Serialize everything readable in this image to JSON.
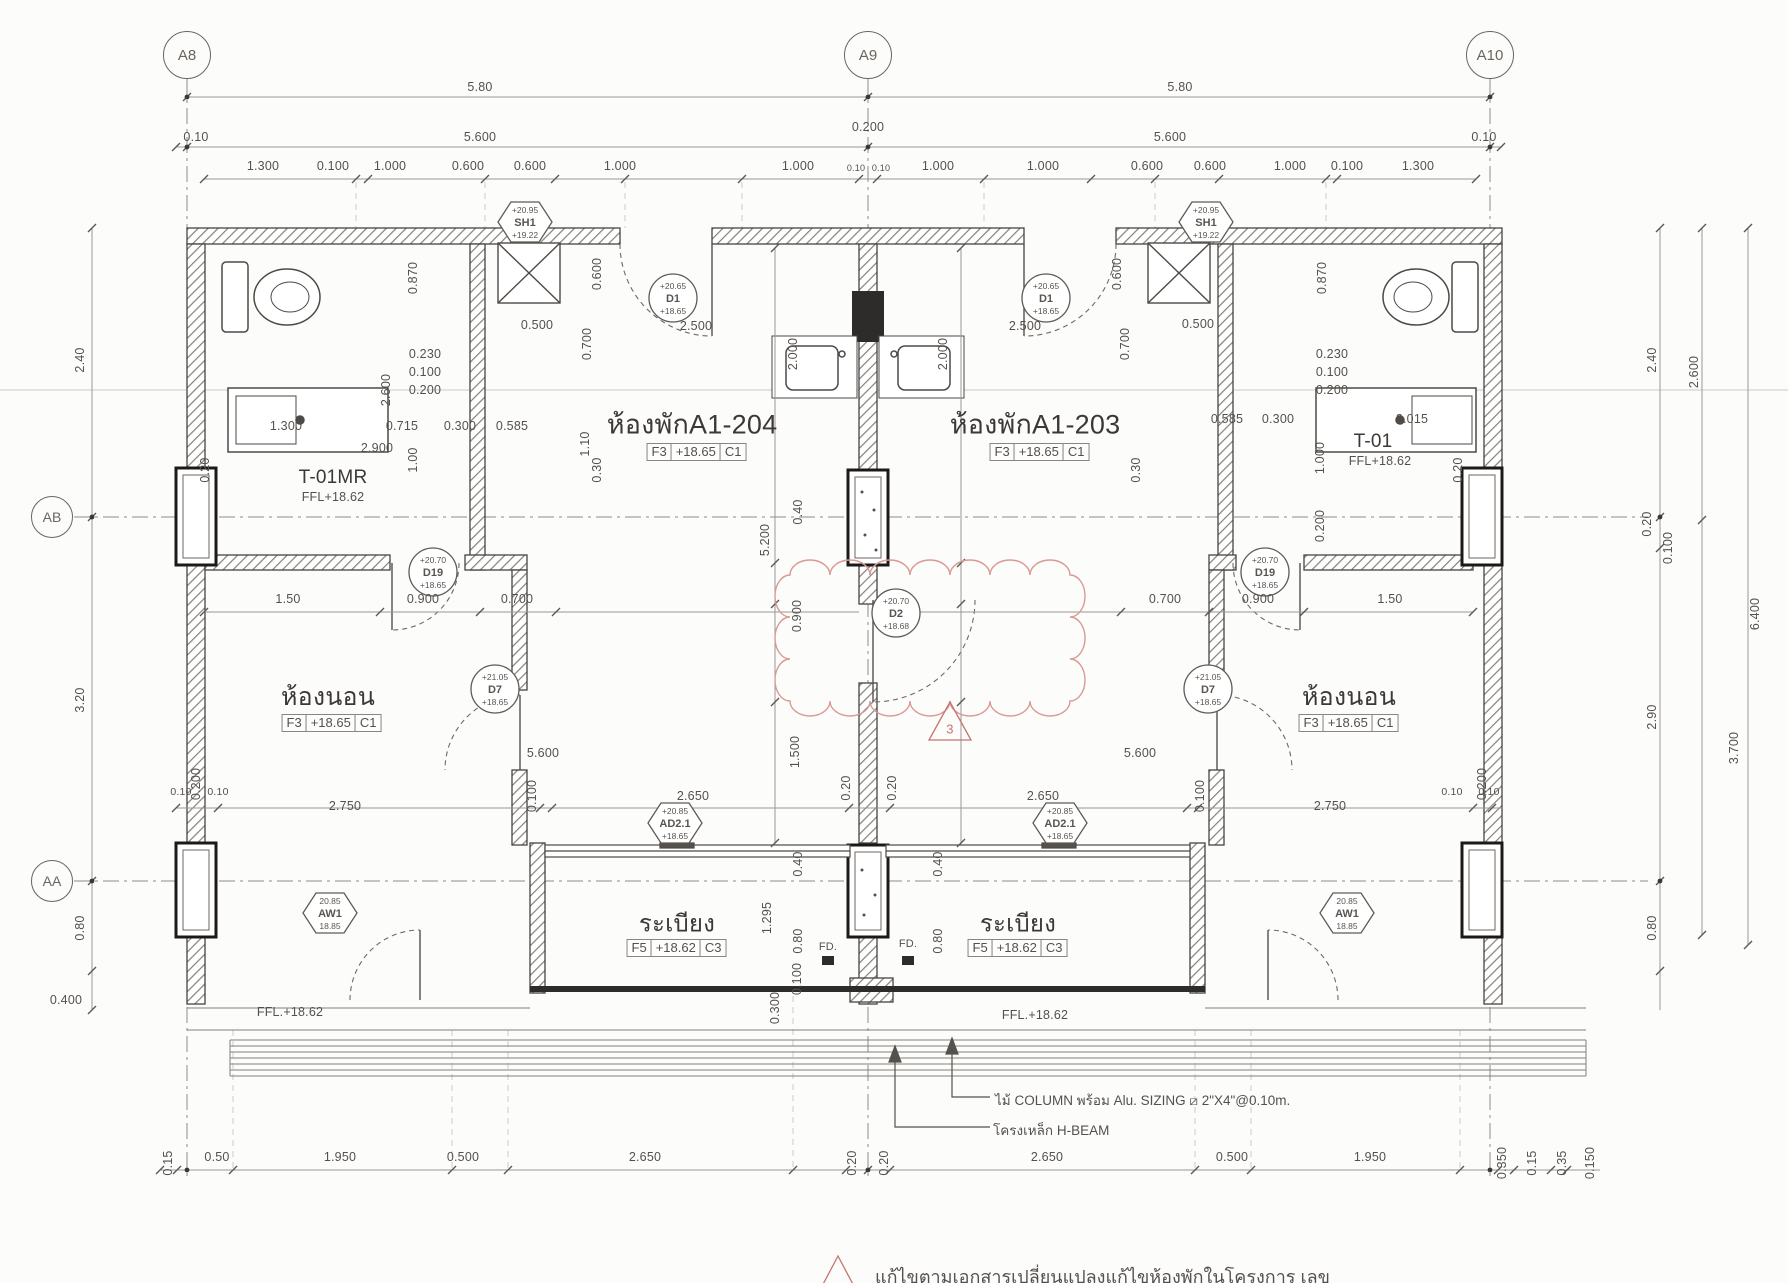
{
  "plan": {
    "grid_bubbles": [
      {
        "id": "A8",
        "x": 187,
        "y": 55,
        "d": 46
      },
      {
        "id": "A9",
        "x": 868,
        "y": 55,
        "d": 46
      },
      {
        "id": "A10",
        "x": 1490,
        "y": 55,
        "d": 46
      },
      {
        "id": "AB",
        "x": 52,
        "y": 517,
        "d": 40
      },
      {
        "id": "AA",
        "x": 52,
        "y": 881,
        "d": 40
      }
    ],
    "rooms": [
      {
        "name": "ห้องพักA1-204",
        "x": 692,
        "y": 424,
        "size": 27,
        "box": [
          "F3",
          "+18.65",
          "C1"
        ],
        "bx": 697,
        "by": 452
      },
      {
        "name": "ห้องพักA1-203",
        "x": 1035,
        "y": 424,
        "size": 27,
        "box": [
          "F3",
          "+18.65",
          "C1"
        ],
        "bx": 1040,
        "by": 452
      },
      {
        "name": "ห้องนอน",
        "x": 328,
        "y": 697,
        "size": 25,
        "box": [
          "F3",
          "+18.65",
          "C1"
        ],
        "bx": 332,
        "by": 723
      },
      {
        "name": "ห้องนอน",
        "x": 1349,
        "y": 697,
        "size": 25,
        "box": [
          "F3",
          "+18.65",
          "C1"
        ],
        "bx": 1349,
        "by": 723
      },
      {
        "name": "ระเบียง",
        "x": 677,
        "y": 923,
        "size": 24,
        "box": [
          "F5",
          "+18.62",
          "C3"
        ],
        "bx": 677,
        "by": 948
      },
      {
        "name": "ระเบียง",
        "x": 1018,
        "y": 923,
        "size": 24,
        "box": [
          "F5",
          "+18.62",
          "C3"
        ],
        "bx": 1018,
        "by": 948
      },
      {
        "name": "T-01MR",
        "x": 333,
        "y": 478,
        "size": 19,
        "sub": "FFL+18.62",
        "sx": 333,
        "sy": 497
      },
      {
        "name": "T-01",
        "x": 1373,
        "y": 442,
        "size": 19,
        "sub": "FFL+18.62",
        "sx": 1380,
        "sy": 461
      }
    ],
    "tags": [
      {
        "code": "D1",
        "shape": "circle",
        "x": 673,
        "y": 298,
        "top": "+20.65",
        "bottom": "+18.65"
      },
      {
        "code": "D1",
        "shape": "circle",
        "x": 1046,
        "y": 298,
        "top": "+20.65",
        "bottom": "+18.65"
      },
      {
        "code": "D19",
        "shape": "circle",
        "x": 433,
        "y": 572,
        "top": "+20.70",
        "bottom": "+18.65"
      },
      {
        "code": "D19",
        "shape": "circle",
        "x": 1265,
        "y": 572,
        "top": "+20.70",
        "bottom": "+18.65"
      },
      {
        "code": "D2",
        "shape": "circle",
        "x": 896,
        "y": 613,
        "top": "+20.70",
        "bottom": "+18.68"
      },
      {
        "code": "D7",
        "shape": "circle",
        "x": 495,
        "y": 689,
        "top": "+21.05",
        "bottom": "+18.65"
      },
      {
        "code": "D7",
        "shape": "circle",
        "x": 1208,
        "y": 689,
        "top": "+21.05",
        "bottom": "+18.65"
      },
      {
        "code": "SH1",
        "shape": "hex",
        "x": 525,
        "y": 222,
        "top": "+20.95",
        "bottom": "+19.22"
      },
      {
        "code": "SH1",
        "shape": "hex",
        "x": 1206,
        "y": 222,
        "top": "+20.95",
        "bottom": "+19.22"
      },
      {
        "code": "AD2.1",
        "shape": "hex",
        "x": 675,
        "y": 823,
        "top": "+20.85",
        "bottom": "+18.65"
      },
      {
        "code": "AD2.1",
        "shape": "hex",
        "x": 1060,
        "y": 823,
        "top": "+20.85",
        "bottom": "+18.65"
      },
      {
        "code": "AW1",
        "shape": "hex",
        "x": 330,
        "y": 913,
        "top": "20.85",
        "bottom": "18.85"
      },
      {
        "code": "AW1",
        "shape": "hex",
        "x": 1347,
        "y": 913,
        "top": "20.85",
        "bottom": "18.85"
      }
    ],
    "dims": [
      {
        "t": "5.80",
        "x": 480,
        "y": 87
      },
      {
        "t": "5.80",
        "x": 1180,
        "y": 87
      },
      {
        "t": "0.10",
        "x": 196,
        "y": 137
      },
      {
        "t": "5.600",
        "x": 480,
        "y": 137
      },
      {
        "t": "0.200",
        "x": 868,
        "y": 127
      },
      {
        "t": "5.600",
        "x": 1170,
        "y": 137
      },
      {
        "t": "0.10",
        "x": 1484,
        "y": 137
      },
      {
        "t": "1.300",
        "x": 263,
        "y": 166
      },
      {
        "t": "0.100",
        "x": 333,
        "y": 166
      },
      {
        "t": "1.000",
        "x": 390,
        "y": 166
      },
      {
        "t": "0.600",
        "x": 468,
        "y": 166
      },
      {
        "t": "0.600",
        "x": 530,
        "y": 166
      },
      {
        "t": "1.000",
        "x": 620,
        "y": 166
      },
      {
        "t": "1.000",
        "x": 798,
        "y": 166
      },
      {
        "t": "0.10",
        "x": 856,
        "y": 168,
        "s": 9
      },
      {
        "t": "0.10",
        "x": 881,
        "y": 168,
        "s": 9
      },
      {
        "t": "1.000",
        "x": 938,
        "y": 166
      },
      {
        "t": "1.000",
        "x": 1043,
        "y": 166
      },
      {
        "t": "0.600",
        "x": 1147,
        "y": 166
      },
      {
        "t": "0.600",
        "x": 1210,
        "y": 166
      },
      {
        "t": "1.000",
        "x": 1290,
        "y": 166
      },
      {
        "t": "0.100",
        "x": 1347,
        "y": 166
      },
      {
        "t": "1.300",
        "x": 1418,
        "y": 166
      },
      {
        "t": "2.40",
        "x": 80,
        "y": 360,
        "r": 1
      },
      {
        "t": "3.20",
        "x": 80,
        "y": 700,
        "r": 1
      },
      {
        "t": "0.80",
        "x": 80,
        "y": 928,
        "r": 1
      },
      {
        "t": "0.400",
        "x": 66,
        "y": 1000
      },
      {
        "t": "2.40",
        "x": 1652,
        "y": 360,
        "r": 1
      },
      {
        "t": "0.20",
        "x": 1647,
        "y": 524,
        "r": 1
      },
      {
        "t": "0.100",
        "x": 1668,
        "y": 548,
        "r": 1
      },
      {
        "t": "2.90",
        "x": 1652,
        "y": 717,
        "r": 1
      },
      {
        "t": "0.80",
        "x": 1652,
        "y": 928,
        "r": 1
      },
      {
        "t": "2.600",
        "x": 1694,
        "y": 372,
        "r": 1
      },
      {
        "t": "3.700",
        "x": 1734,
        "y": 748,
        "r": 1
      },
      {
        "t": "6.400",
        "x": 1755,
        "y": 614,
        "r": 1
      },
      {
        "t": "0.15",
        "x": 168,
        "y": 1163,
        "r": 1
      },
      {
        "t": "0.50",
        "x": 217,
        "y": 1157
      },
      {
        "t": "1.950",
        "x": 340,
        "y": 1157
      },
      {
        "t": "0.500",
        "x": 463,
        "y": 1157
      },
      {
        "t": "2.650",
        "x": 645,
        "y": 1157
      },
      {
        "t": "0.20",
        "x": 852,
        "y": 1163,
        "r": 1
      },
      {
        "t": "0.20",
        "x": 884,
        "y": 1163,
        "r": 1
      },
      {
        "t": "2.650",
        "x": 1047,
        "y": 1157
      },
      {
        "t": "0.500",
        "x": 1232,
        "y": 1157
      },
      {
        "t": "1.950",
        "x": 1370,
        "y": 1157
      },
      {
        "t": "0.350",
        "x": 1502,
        "y": 1163,
        "r": 1
      },
      {
        "t": "0.15",
        "x": 1532,
        "y": 1163,
        "r": 1
      },
      {
        "t": "0.35",
        "x": 1562,
        "y": 1163,
        "r": 1
      },
      {
        "t": "0.150",
        "x": 1590,
        "y": 1163,
        "r": 1
      },
      {
        "t": "0.870",
        "x": 413,
        "y": 278,
        "r": 1
      },
      {
        "t": "0.500",
        "x": 537,
        "y": 325
      },
      {
        "t": "2.500",
        "x": 696,
        "y": 326
      },
      {
        "t": "0.600",
        "x": 597,
        "y": 274,
        "r": 1
      },
      {
        "t": "0.700",
        "x": 587,
        "y": 344,
        "r": 1
      },
      {
        "t": "0.230",
        "x": 425,
        "y": 354
      },
      {
        "t": "0.100",
        "x": 425,
        "y": 372
      },
      {
        "t": "0.200",
        "x": 425,
        "y": 390
      },
      {
        "t": "2.600",
        "x": 386,
        "y": 390,
        "r": 1
      },
      {
        "t": "1.300",
        "x": 286,
        "y": 426
      },
      {
        "t": "0.715",
        "x": 402,
        "y": 426
      },
      {
        "t": "0.300",
        "x": 460,
        "y": 426
      },
      {
        "t": "0.585",
        "x": 512,
        "y": 426
      },
      {
        "t": "2.900",
        "x": 377,
        "y": 448
      },
      {
        "t": "1.00",
        "x": 413,
        "y": 460,
        "r": 1
      },
      {
        "t": "2.000",
        "x": 793,
        "y": 354,
        "r": 1
      },
      {
        "t": "1.10",
        "x": 585,
        "y": 444,
        "r": 1
      },
      {
        "t": "0.20",
        "x": 205,
        "y": 470,
        "r": 1
      },
      {
        "t": "0.30",
        "x": 597,
        "y": 470,
        "r": 1
      },
      {
        "t": "5.200",
        "x": 765,
        "y": 540,
        "r": 1
      },
      {
        "t": "0.40",
        "x": 798,
        "y": 512,
        "r": 1
      },
      {
        "t": "0.900",
        "x": 797,
        "y": 616,
        "r": 1
      },
      {
        "t": "1.500",
        "x": 795,
        "y": 752,
        "r": 1
      },
      {
        "t": "1.50",
        "x": 288,
        "y": 599
      },
      {
        "t": "0.900",
        "x": 423,
        "y": 599
      },
      {
        "t": "0.700",
        "x": 517,
        "y": 599
      },
      {
        "t": "5.600",
        "x": 543,
        "y": 753
      },
      {
        "t": "0.200",
        "x": 196,
        "y": 784,
        "r": 1
      },
      {
        "t": "0.10",
        "x": 181,
        "y": 792,
        "s": 10.5
      },
      {
        "t": "0.10",
        "x": 218,
        "y": 792,
        "s": 10.5
      },
      {
        "t": "2.750",
        "x": 345,
        "y": 806
      },
      {
        "t": "0.100",
        "x": 532,
        "y": 796,
        "r": 1
      },
      {
        "t": "2.650",
        "x": 693,
        "y": 796
      },
      {
        "t": "0.20",
        "x": 846,
        "y": 788,
        "r": 1
      },
      {
        "t": "0.20",
        "x": 892,
        "y": 788,
        "r": 1
      },
      {
        "t": "0.40",
        "x": 798,
        "y": 864,
        "r": 1
      },
      {
        "t": "1.295",
        "x": 767,
        "y": 918,
        "r": 1
      },
      {
        "t": "0.80",
        "x": 798,
        "y": 941,
        "r": 1
      },
      {
        "t": "0.100",
        "x": 797,
        "y": 979,
        "r": 1
      },
      {
        "t": "0.300",
        "x": 775,
        "y": 1008,
        "r": 1
      },
      {
        "t": "0.870",
        "x": 1322,
        "y": 278,
        "r": 1
      },
      {
        "t": "0.500",
        "x": 1198,
        "y": 324
      },
      {
        "t": "2.500",
        "x": 1025,
        "y": 326
      },
      {
        "t": "0.600",
        "x": 1117,
        "y": 274,
        "r": 1
      },
      {
        "t": "0.700",
        "x": 1125,
        "y": 344,
        "r": 1
      },
      {
        "t": "0.230",
        "x": 1332,
        "y": 354
      },
      {
        "t": "0.100",
        "x": 1332,
        "y": 372
      },
      {
        "t": "0.200",
        "x": 1332,
        "y": 390
      },
      {
        "t": "0.585",
        "x": 1227,
        "y": 419
      },
      {
        "t": "0.300",
        "x": 1278,
        "y": 419
      },
      {
        "t": "2.015",
        "x": 1412,
        "y": 419
      },
      {
        "t": "1.000",
        "x": 1320,
        "y": 458,
        "r": 1
      },
      {
        "t": "0.200",
        "x": 1320,
        "y": 526,
        "r": 1
      },
      {
        "t": "2.000",
        "x": 943,
        "y": 354,
        "r": 1
      },
      {
        "t": "0.30",
        "x": 1136,
        "y": 470,
        "r": 1
      },
      {
        "t": "0.20",
        "x": 1458,
        "y": 470,
        "r": 1
      },
      {
        "t": "0.700",
        "x": 1165,
        "y": 599
      },
      {
        "t": "0.900",
        "x": 1258,
        "y": 599
      },
      {
        "t": "1.50",
        "x": 1390,
        "y": 599
      },
      {
        "t": "5.600",
        "x": 1140,
        "y": 753
      },
      {
        "t": "2.650",
        "x": 1043,
        "y": 796
      },
      {
        "t": "0.100",
        "x": 1200,
        "y": 796,
        "r": 1
      },
      {
        "t": "2.750",
        "x": 1330,
        "y": 806
      },
      {
        "t": "0.10",
        "x": 1452,
        "y": 792,
        "s": 10.5
      },
      {
        "t": "0.10",
        "x": 1489,
        "y": 792,
        "s": 10.5
      },
      {
        "t": "0.200",
        "x": 1482,
        "y": 784,
        "r": 1
      },
      {
        "t": "0.40",
        "x": 938,
        "y": 864,
        "r": 1
      },
      {
        "t": "0.80",
        "x": 938,
        "y": 941,
        "r": 1
      }
    ],
    "labels": [
      {
        "t": "FFL.+18.62",
        "x": 290,
        "y": 1012,
        "s": 12.5
      },
      {
        "t": "FFL.+18.62",
        "x": 1035,
        "y": 1015,
        "s": 12.5
      },
      {
        "t": "FD.",
        "x": 828,
        "y": 947,
        "s": 11
      },
      {
        "t": "FD.",
        "x": 908,
        "y": 944,
        "s": 11
      },
      {
        "t": "3",
        "x": 950,
        "y": 729,
        "s": 13,
        "red": 1
      }
    ],
    "notes": {
      "column_note": "ไม้ COLUMN  พร้อม Alu.  SIZING ⧄ 2\"X4\"@0.10m.",
      "beam_note": "โครงเหล็ก H-BEAM"
    },
    "revision": {
      "marker": "3",
      "text": "แก้ไขตามเอกสารเปลี่ยนแปลงแก้ไขห้องพักในโครงการ เลข"
    }
  }
}
